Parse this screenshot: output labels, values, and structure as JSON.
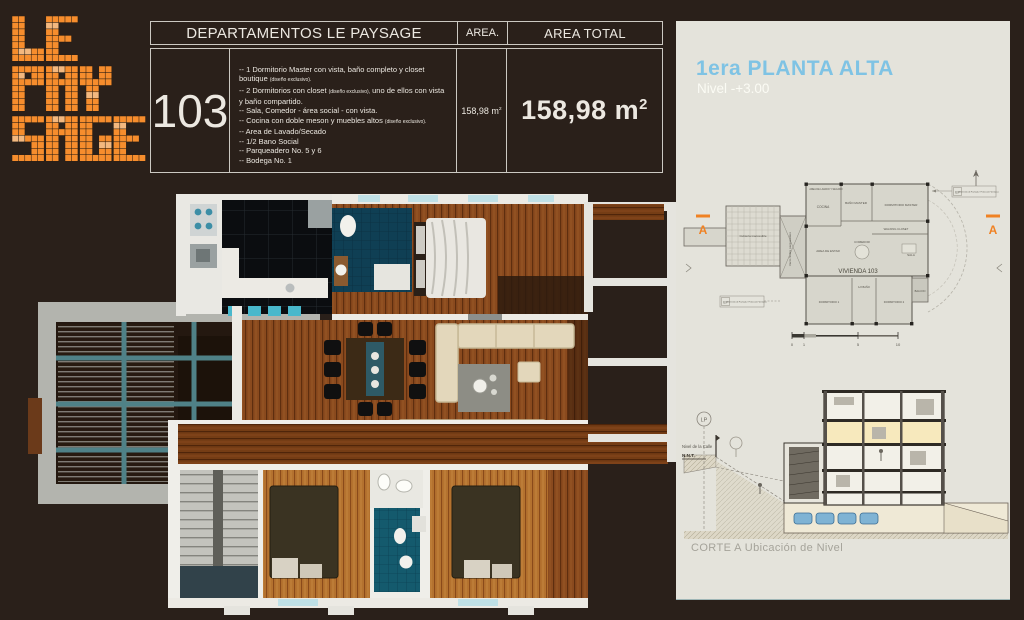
{
  "colors": {
    "background": "#2a201a",
    "accent_orange": "#f68d2d",
    "accent_orange_light": "#f3b87f",
    "panel_background": "#e4e3db",
    "title_blue": "#7fc3e4",
    "teal_tile": "#145a6d",
    "wood": "#8a4a1e"
  },
  "logo": {
    "alt": "LE PAYSAGE",
    "lines": [
      "LE",
      "PAY",
      "SAGE"
    ],
    "color": "#f68d2d",
    "light_color": "#f3b87f"
  },
  "spec_table": {
    "header": {
      "departamentos": "DEPARTAMENTOS LE PAYSAGE",
      "area": "AREA.",
      "area_total": "AREA TOTAL"
    },
    "unit_number": "103",
    "bullet_prefix": "--",
    "features": [
      {
        "text": "1 Dormitorio Master con vista, baño completo y closet boutique ",
        "note": "(diseño exclusivo)."
      },
      {
        "text": "2 Dormitorios con closet ",
        "note": "(diseño exclusivo),",
        "text2": " uno de ellos con vista y baño compartido."
      },
      {
        "text": "Sala, Comedor - área social - con vista."
      },
      {
        "text": "Cocina con doble meson y muebles altos ",
        "note": "(diseño exclusivo)."
      },
      {
        "text": "Area de Lavado/Secado"
      },
      {
        "text": "1/2 Bano Social"
      },
      {
        "text": "Parqueadero No. 5 y 6"
      },
      {
        "text": "Bodega No. 1"
      }
    ],
    "area_value": "158,98 m",
    "area_sup": "2",
    "area_total_value": "158,98 m",
    "area_total_sup": "2"
  },
  "panel": {
    "title": "1era PLANTA ALTA",
    "subtitle": "Nivel  -+3.00",
    "plan": {
      "labels": {
        "lavado": "AREA DE LAVADO Y SECADO",
        "cocina": "COCINA",
        "bano_master": "BAÑO MASTER",
        "dormitorio_master": "DORMITORIO MASTER",
        "walking_closet": "WALKING CLOSET",
        "area_estar": "AREA DE ESTAR",
        "comedor": "COMEDOR",
        "sala": "SALA",
        "vivienda": "VIVIENDA 103",
        "balcon": "BALCON",
        "dormitorio1": "DORMITORIO 1",
        "dormitorio2": "DORMITORIO 2",
        "medio_bano": "1/2 BAÑO",
        "vacio": "Vacío Sobre parqueadero",
        "cubierta": "Cubierta inaccesible",
        "ef_tag": "EF",
        "ef_note": "Elemento de Fachada / Protección Ventanas",
        "section_marker": "A",
        "scale_0": "0",
        "scale_1": "1",
        "scale_5": "5",
        "scale_10": "10"
      }
    },
    "section": {
      "lp": "LP",
      "street_level": "Nivel de la Calle",
      "nnt": "N.N.T.",
      "caption": "CORTE A Ubicación de Nivel"
    }
  }
}
